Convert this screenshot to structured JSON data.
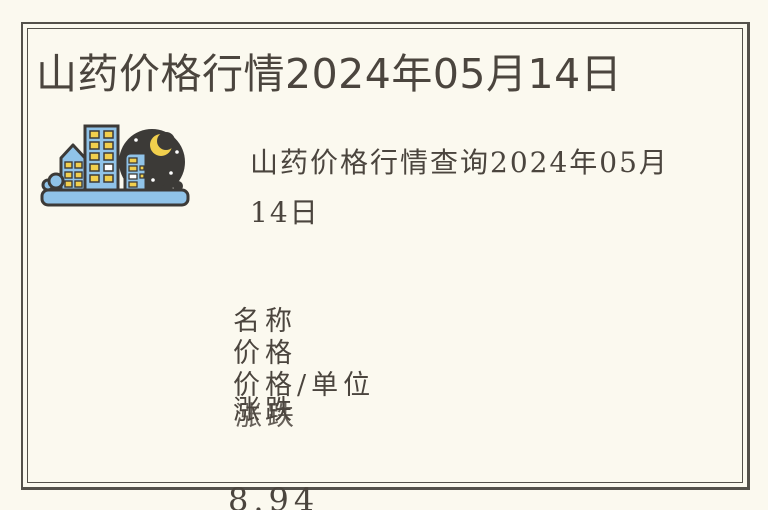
{
  "theme": {
    "background": "#FBF9EF",
    "border": "#54514B",
    "text": "#4B453E"
  },
  "icon": {
    "name": "night-city-skyline",
    "building": "#90C3E8",
    "ground": "#90C3E8",
    "window": "#F1CF4D",
    "window_alt": "#FFFFFF",
    "night_sky": "#3C3A37",
    "moon": "#F1CF4D",
    "star": "#FFFFFF",
    "outline": "#3C3A37"
  },
  "article": {
    "title": "山药价格行情2024年05月14日",
    "image_caption": "山药价格行情查询2024年05月14日",
    "price_table": {
      "headers": [
        "名称",
        "价格",
        "价格/单位",
        "涨跌"
      ],
      "visible_values": [
        "8.94"
      ]
    }
  }
}
